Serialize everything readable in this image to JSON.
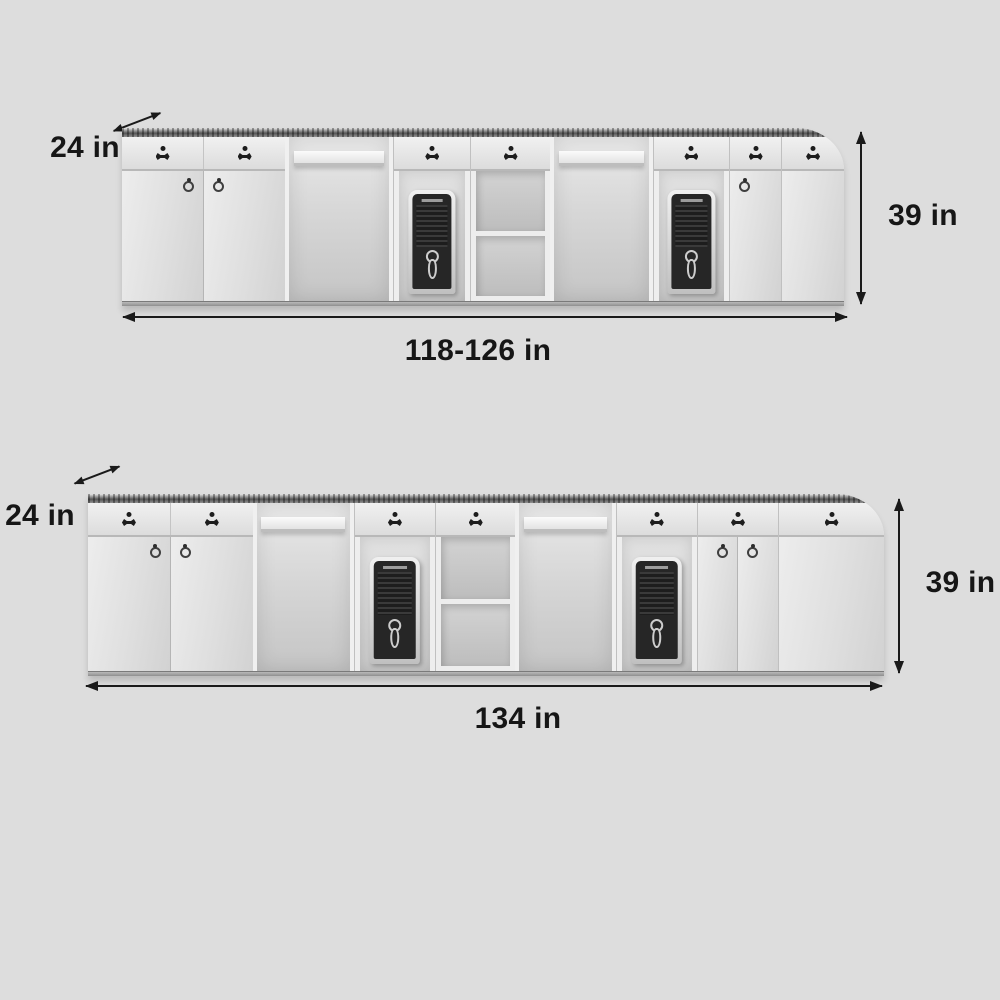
{
  "page": {
    "background_color": "#dddddd",
    "content": "Reception desk product dimension diagrams, two size variants"
  },
  "colors": {
    "label_text": "#161616",
    "arrow": "#1a1a1a",
    "cabinet_light": "#ededed",
    "cabinet_shade": "#d2d2d2",
    "countertop": "#4e4e4e",
    "tower_face": "#262626",
    "tower_frame": "#d8d8d8"
  },
  "icons": {
    "depth-arrow": "diagonal double-headed arrow (css triangles)",
    "height-arrow": "vertical double-headed arrow (css triangles)",
    "width-arrow": "horizontal double-headed arrow (css triangles)",
    "lock-keyhole-icon": "dot over winged escutcheon (css clip-path)",
    "ring-pull-icon": "circle with pivot dot (css)",
    "keyhole-handle-icon": "keyhole outline (css)"
  },
  "diagrams": [
    {
      "id": "variant-1",
      "depth_label": "24 in",
      "height_label": "39 in",
      "width_label": "118-126 in"
    },
    {
      "id": "variant-2",
      "depth_label": "24 in",
      "height_label": "39 in",
      "width_label": "134 in"
    }
  ]
}
